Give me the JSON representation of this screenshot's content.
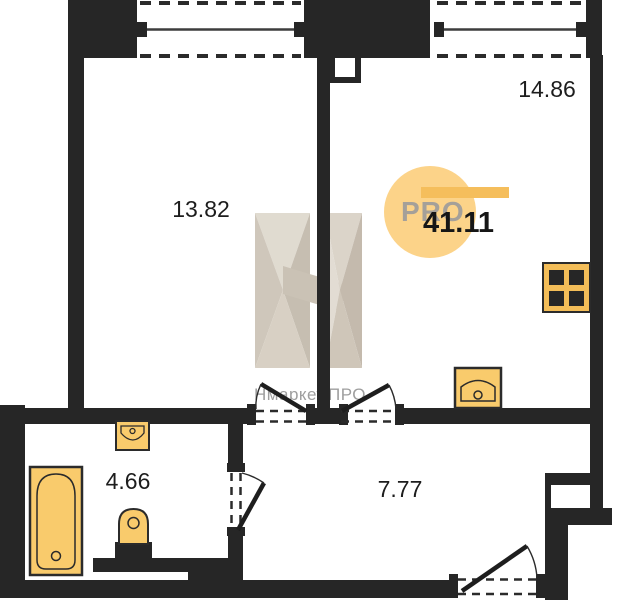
{
  "rooms": [
    {
      "id": "room-left",
      "area": "13.82"
    },
    {
      "id": "room-right",
      "area": "14.86"
    },
    {
      "id": "bathroom",
      "area": "4.66"
    },
    {
      "id": "hallway",
      "area": "7.77"
    }
  ],
  "total_area": "41.11",
  "watermark": {
    "logo_text": "PRO",
    "caption": "Нмаркет.ПРО"
  },
  "colors": {
    "wall": "#262626",
    "fixture_fill": "#F9CB6C",
    "fixture_stroke": "#2B2B2B",
    "watermark_circle": "#FCD389",
    "watermark_bar": "#F5BE5C",
    "watermark_text": "#A5A099",
    "label_text": "#1D1D1D",
    "facet_beige_light": "#E0DAD0",
    "facet_beige_mid": "#CCC3B6",
    "facet_beige_dark": "#BCB2A4"
  },
  "fixtures": [
    "bathtub-icon",
    "wash-basin-icon",
    "toilet-icon",
    "kitchen-sink-icon",
    "stove-icon"
  ]
}
